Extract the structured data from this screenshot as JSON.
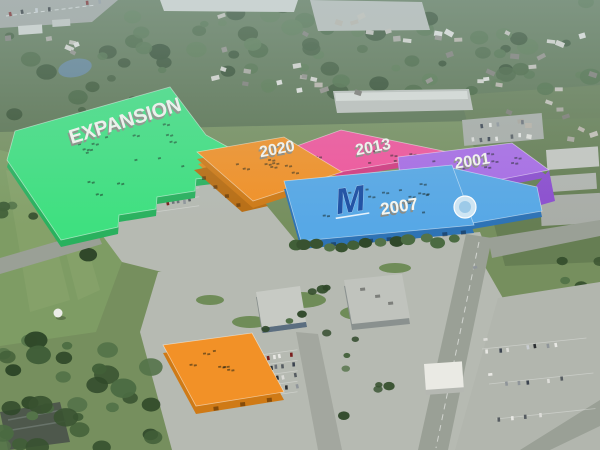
{
  "scene": {
    "label_text_color": "#f7f7f1"
  },
  "buildings": {
    "expansion": {
      "label": "EXPANSION",
      "color": "#3fe080"
    },
    "phase2020": {
      "label": "2020",
      "color": "#f29127"
    },
    "phase2013": {
      "label": "2013",
      "color": "#f2549b"
    },
    "phase2001": {
      "label": "2001",
      "color": "#a96ce6"
    },
    "phase2007": {
      "label": "2007",
      "color": "#57a8e6",
      "logo": "M",
      "logo_color": "#1d4fa3"
    },
    "annex": {
      "color": "#f29127"
    }
  }
}
